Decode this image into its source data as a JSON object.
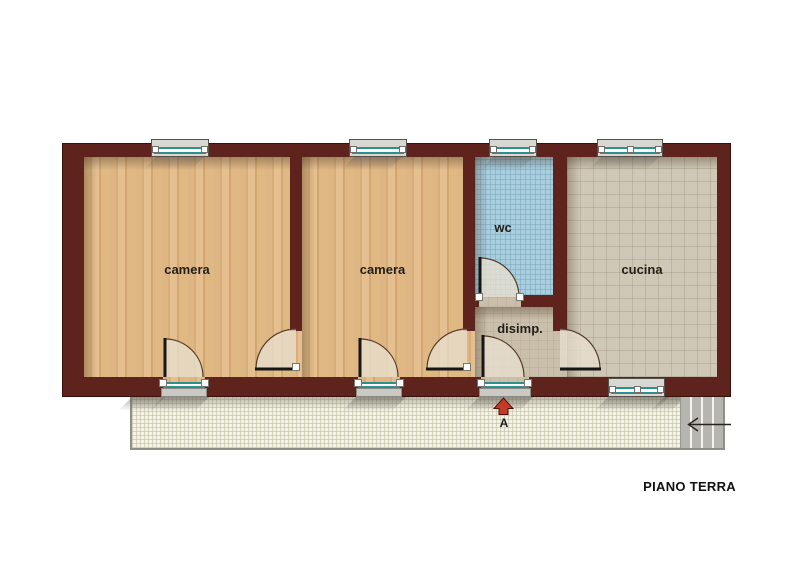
{
  "floor_plan": {
    "title": "PIANO TERRA",
    "rooms": [
      {
        "id": "camera-1",
        "label": "camera",
        "floor": "wood"
      },
      {
        "id": "camera-2",
        "label": "camera",
        "floor": "wood"
      },
      {
        "id": "wc",
        "label": "wc",
        "floor": "blue-tile"
      },
      {
        "id": "disimp",
        "label": "disimp.",
        "floor": "screed"
      },
      {
        "id": "cucina",
        "label": "cucina",
        "floor": "tile"
      }
    ],
    "entrance_marker": "A"
  },
  "colors": {
    "wall": "#5e231d",
    "wood": "#deb684",
    "wc-tile": "#a9cfdf",
    "cucina-tile": "#cfc8b6",
    "disimp-floor": "#c9bfab",
    "terrace": "#f3f2e4",
    "glass": "#2e8f8c",
    "window-frame": "#d8d7d2",
    "stairs": "#b7b5b0",
    "arrow-red": "#c43a28",
    "text": "#241e1a"
  }
}
